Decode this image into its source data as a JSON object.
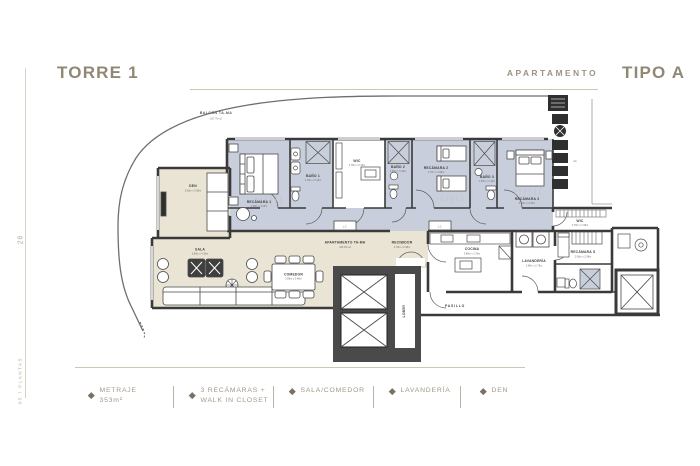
{
  "header": {
    "tower": "TORRE 1",
    "apartment_label": "APARTAMENTO",
    "type_label": "TIPO A"
  },
  "sidebar": {
    "page_number": "26",
    "caption": "05 / PLANTAS"
  },
  "legend": {
    "items": [
      {
        "line1": "METRAJE",
        "line2": "353m²"
      },
      {
        "line1": "3 RECÁMARAS +",
        "line2": "WALK IN CLOSET"
      },
      {
        "line1": "SALA/COMEDOR",
        "line2": ""
      },
      {
        "line1": "LAVANDERÍA",
        "line2": ""
      },
      {
        "line1": "DEN",
        "line2": ""
      }
    ]
  },
  "plan": {
    "balcony": {
      "label": "BALCÓN TA-MA",
      "area": "187.76 m2"
    },
    "apartment": {
      "label": "APARTAMENTO TA-MA",
      "area": "348.93 m2"
    },
    "rooms": {
      "den": {
        "label": "DEN",
        "dims": "3.08m x 3.98m"
      },
      "sala": {
        "label": "SALA",
        "dims": "6.88m x 4.18m"
      },
      "comedor": {
        "label": "COMEDOR",
        "dims": "3.88m x 2.48m"
      },
      "recamara1": {
        "label": "RECÁMARA 1",
        "dims": "3.98m x 4.28m"
      },
      "bano1": {
        "label": "BAÑO 1",
        "dims": "1.78m x 3.18m"
      },
      "wic1": {
        "label": "WIC",
        "dims": "2.78m x 3.18m"
      },
      "bano2": {
        "label": "BAÑO 2",
        "dims": "1.58m x 3.18m"
      },
      "recamara2": {
        "label": "RECÁMARA 2",
        "dims": "3.78m x 3.98m"
      },
      "bano3": {
        "label": "BAÑO 3",
        "dims": "1.58m x 3.18m"
      },
      "recamara3": {
        "label": "RECÁMARA 3",
        "dims": "3.98m x 4.08m"
      },
      "wic3": {
        "label": "WIC",
        "dims": "2.78m x 1.58m"
      },
      "recibidor": {
        "label": "RECIBIDOR",
        "dims": "2.78m x 2.98m"
      },
      "cocina": {
        "label": "COCINA",
        "dims": "3.88m x 3.78m"
      },
      "lavanderia": {
        "label": "LAVANDERÍA",
        "dims": "2.98m x 2.78m"
      },
      "recamara_s": {
        "label": "RECÁMARA S",
        "dims": "2.08m x 2.98m"
      },
      "lobby": {
        "label": "LOBBY"
      },
      "pasillo": {
        "label": "PASILLO"
      },
      "aa": {
        "label": "AA"
      },
      "lc": {
        "label": "L.C."
      }
    }
  },
  "colors": {
    "accent_text": "#8f8875",
    "rule_line": "#cdc5b6",
    "wall": "#3a3a3a",
    "bedroom_fill": "#c8cedb",
    "living_fill": "#e9e4d3",
    "shower_fill": "#c9cfda"
  }
}
